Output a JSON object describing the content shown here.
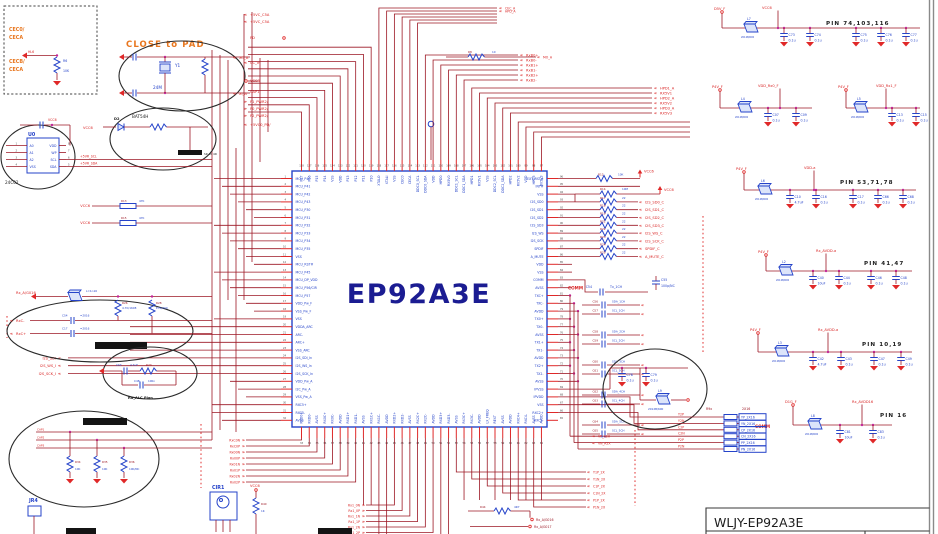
{
  "colors": {
    "wire": "#9c1724",
    "bright": "#e02828",
    "component_blue": "#2543c9",
    "chip_navy": "#1b1c92",
    "orange": "#e8761e",
    "junction_pink": "#c2269a"
  },
  "title_block": {
    "title": "WLJY-EP92A3E"
  },
  "notes": {
    "close_to_pad": "CLOSE to PAD"
  },
  "chip": {
    "label": "EP92A3E",
    "left_pins": [
      "MCU_P40",
      "MCU_P41",
      "MCU_P42",
      "MCU_P43",
      "MCU_P30",
      "MCU_P31",
      "MCU_P32",
      "MCU_P33",
      "MCU_P34",
      "MCU_P35",
      "VSS",
      "MCU_RST#",
      "MCU_P45",
      "MCU_DP_VDD",
      "MCU_P56/CIR",
      "MCU_P57",
      "VDD_Pw_F",
      "VSS_Pw_F",
      "VSS",
      "VDDA_ARC",
      "ARC-",
      "ARC+",
      "VSS_ARC",
      "I2S_SDI_In",
      "I2S_WS_In",
      "I2S_SCK_In",
      "VDD_Pw_A",
      "I2C_Pw_A",
      "VSS_Pw_A",
      "RXC5+",
      "RXC5-",
      "AVSS"
    ],
    "right_pins": [
      "EXT_RST#",
      "INT#",
      "VSS",
      "I2S_SD0",
      "I2S_SD1",
      "I2S_SD2",
      "I2S_SD3",
      "I2S_WS",
      "I2S_SCK",
      "SPDIF",
      "A_MUTE",
      "VDD",
      "VSS",
      "COMM",
      "AVSS",
      "TXC+",
      "TXC-",
      "AVDD",
      "TX0+",
      "TX0-",
      "AVSS",
      "TX1+",
      "TX1-",
      "AVDD",
      "TX2+",
      "TX2-",
      "AVSS",
      "IPVSS",
      "IPVDD",
      "VSS",
      "RXC2+",
      "RXC2-"
    ],
    "top_pins": [
      "P17",
      "P16",
      "P15",
      "P14",
      "VSS",
      "VDD",
      "P13",
      "P12",
      "P11",
      "P10",
      "XTALO",
      "XTALI",
      "VSS",
      "CEC0",
      "CECA",
      "DDC0_SCL",
      "DDC0_SDA",
      "VDD",
      "HPD0",
      "RX5V0",
      "DDC1_SCL",
      "DDC1_SDA",
      "HPD1",
      "RX5V1",
      "VSS",
      "DDC2_SCL",
      "DDC2_SDA",
      "HPD2",
      "RX5V2",
      "VDD",
      "HPD3",
      "RX5V3"
    ],
    "bottom_pins": [
      "RXD0+",
      "RXD0-",
      "AVSS",
      "RX0C+",
      "RX0C-",
      "AVDD",
      "RXD1+",
      "RXD1-",
      "AVSS",
      "RX1C+",
      "RX1C-",
      "AVDD",
      "RXD2+",
      "RXD2-",
      "AVSS",
      "RX2C+",
      "RX2C-",
      "AVDD",
      "RXD3+",
      "RXD3-",
      "AVSS",
      "RX3C+",
      "RX3C-",
      "AVDD",
      "LX_FREQ",
      "REXT",
      "AVSS",
      "AVDD",
      "RXC4+",
      "RXC4-",
      "AVSS",
      "AVDD"
    ]
  },
  "cec_box": {
    "top1": "CEC0/",
    "top2": "CECA",
    "net": "HL6",
    "bot1": "CECB/",
    "bot2": "CECA",
    "r_ref": "R6",
    "r_val": "10K"
  },
  "crystal": {
    "ref": "Y1",
    "val": "24M",
    "net_top": "XO_A",
    "net_bot": "XI_A"
  },
  "diode": {
    "net": "VCC6",
    "ref": "D2",
    "part": "BAT54H",
    "ind": "SR 40 4R"
  },
  "eeprom": {
    "ref": "U0",
    "part": "24C02",
    "cap_net": "VCC6",
    "left_pins": [
      "A0",
      "A1",
      "A2",
      "VSS"
    ],
    "right_pins": [
      "VDD",
      "WP",
      "SCL",
      "SDA"
    ],
    "nets": [
      "+5VR_SCL",
      "+5VR_SDA"
    ]
  },
  "power_groups": [
    {
      "title": "PIN 74,103,116",
      "left": "D5V_F",
      "right": "VCC6",
      "bead_ref": "L7",
      "bead": "2012B/600",
      "caps": [
        {
          "r": "C73",
          "v": "0.1u"
        },
        {
          "r": "C74",
          "v": "0.1u"
        },
        {
          "r": "C75",
          "v": "0.1u"
        },
        {
          "r": "C76",
          "v": "0.1u"
        },
        {
          "r": "C77",
          "v": "0.1u"
        }
      ]
    },
    {
      "title": "",
      "left": "P4V_F",
      "right": "VDD_Rx0_F",
      "bead_ref": "L4",
      "bead": "2012B/600",
      "caps": [
        {
          "r": "C07",
          "v": "0.1u"
        },
        {
          "r": "C09",
          "v": "0.1u"
        }
      ]
    },
    {
      "title": "",
      "left": "P4V_F",
      "right": "VDD_Rx1_F",
      "bead_ref": "L5",
      "bead": "2012B/600",
      "caps": [
        {
          "r": "C13",
          "v": "0.1u"
        },
        {
          "r": "C15",
          "v": "0.1u"
        }
      ]
    },
    {
      "title": "PIN 53,71,78",
      "left": "P4V_F",
      "right": "VDD-a",
      "bead_ref": "L6",
      "bead": "2012B/600",
      "caps": [
        {
          "r": "C10",
          "v": "4.7uF"
        },
        {
          "r": "C16",
          "v": "0.1u"
        },
        {
          "r": "C17",
          "v": "0.1u"
        },
        {
          "r": "C66",
          "v": "0.1u"
        },
        {
          "r": "C68",
          "v": "0.1u"
        }
      ]
    },
    {
      "title": "PIN 41,47",
      "left": "P4V_F",
      "right": "Rx_AVDD-a",
      "bead_ref": "L2",
      "bead": "2012B/600",
      "caps": [
        {
          "r": "C40",
          "v": "10uF"
        },
        {
          "r": "C44",
          "v": "0.1u"
        },
        {
          "r": "C46",
          "v": "0.1u"
        },
        {
          "r": "C48",
          "v": "0.1u"
        }
      ]
    },
    {
      "title": "PIN 10,19",
      "left": "P4V_F",
      "right": "Rx_AVDD-a",
      "bead_ref": "L3",
      "bead": "2012B/600",
      "caps": [
        {
          "r": "C42",
          "v": "4.7uF"
        },
        {
          "r": "C43",
          "v": "0.1u"
        },
        {
          "r": "C47",
          "v": "0.1u"
        },
        {
          "r": "C49",
          "v": "0.1u"
        }
      ]
    },
    {
      "title": "PIN 16",
      "left": "D1G_F",
      "right": "Rx_AVDD16",
      "bead_ref": "L8",
      "bead": "2012B/600",
      "comm": "COMM",
      "caps": [
        {
          "r": "C81",
          "v": "10uF"
        },
        {
          "r": "C83",
          "v": "0.1u"
        }
      ]
    }
  ],
  "e7": {
    "bead_ref": "L9",
    "bead": "2012B/600",
    "caps": [
      {
        "r": "C78",
        "v": "0.1u"
      },
      {
        "r": "C79",
        "v": "0.1u"
      }
    ]
  },
  "resnet": {
    "hdr_l": "R9x",
    "hdr_r": "2X16",
    "rows": [
      {
        "l": "Y2P",
        "b": "YP_2X16"
      },
      {
        "l": "Y2N",
        "b": "YN_2X16"
      },
      {
        "l": "C2P",
        "b": "CP_2X16"
      },
      {
        "l": "C2N",
        "b": "CN_2X16"
      },
      {
        "l": "P2P",
        "b": "PP_2X16"
      },
      {
        "l": "P2N",
        "b": "PN_2X16"
      }
    ]
  },
  "left_col": [
    "+5VC_C5A",
    "+5VC_C5A",
    "PD",
    "CC_In",
    "VCC6",
    "CAP1",
    "P1_PWR2/",
    "P0_PWR2/",
    "P2_PWR2/",
    "+5VC0_PD/"
  ],
  "vcc_rows": [
    {
      "net": "VCC6",
      "ref": "R13",
      "val": "47K"
    },
    {
      "net": "VCC6",
      "ref": "R15",
      "val": "47K"
    }
  ],
  "topright": {
    "r_ref": "R8",
    "r_val": "10",
    "net": "MO_A",
    "top2": [
      "CEC_A",
      "HPD_A"
    ],
    "stack": [
      "RxB0+",
      "RxB0-",
      "RxB1+",
      "RxB1-",
      "RxB2+",
      "RxB2-"
    ],
    "mid": [
      "HPD1_A",
      "RX5V1",
      "HPD2_A",
      "RX5V2",
      "HPD3_A",
      "RX5V3"
    ]
  },
  "pullup": {
    "ref": "R12",
    "val": "10K",
    "net": "VCC6"
  },
  "i2s": {
    "val": "22",
    "refs": [
      "R17",
      "R18",
      "R19",
      "R21",
      "R22",
      "R23",
      "R24",
      "R25"
    ],
    "labels": [
      "I2S_SD0_C",
      "I2S_SD1_C",
      "I2S_SD2_C",
      "I2S_SD3_C",
      "I2S_WS_C",
      "I2S_SCK_C",
      "SPDIF_C",
      "A_MUTE_C"
    ],
    "pull": {
      "ref": "R1b",
      "val": "10M",
      "net": "VCC6"
    }
  },
  "commcaps": {
    "hdr": "COMM",
    "hdr_ref": "C54",
    "hdr_lab": "Tx_1CH",
    "nc_ref": "C55",
    "nc_val": "100p/NC",
    "rows": [
      {
        "ref": "C56",
        "lab": "SDA_1CH"
      },
      {
        "ref": "C57",
        "lab": "SCL_1CH"
      },
      {
        "ref": "C58",
        "lab": "SDA_2CH"
      },
      {
        "ref": "C59",
        "lab": "SCL_2CH"
      },
      {
        "ref": "C60",
        "lab": "SDA_3CH"
      },
      {
        "ref": "C61",
        "lab": "SCL_3CH"
      },
      {
        "ref": "C62",
        "lab": "SDA_4CH"
      },
      {
        "ref": "C63",
        "lab": "SCL_4CH"
      },
      {
        "ref": "C64",
        "lab": "SDA_5CH"
      },
      {
        "ref": "C65",
        "lab": "SCL_5CH"
      }
    ]
  },
  "filters": {
    "net": "Rx_A/G016",
    "bead": "L=1n16",
    "r1_ref": "R26",
    "r1_val": "4.7K/1608",
    "r2_ref": "R28",
    "r2_val": "E78/400",
    "c1": "C54",
    "c2": "C17",
    "cv": "=2016",
    "in1": "RxC-",
    "in2": "RxC+"
  },
  "agc": {
    "c1_ref": "C63",
    "c1_val": "4.7uF",
    "r_ref": "R20",
    "c2_ref": "C48",
    "c2_val": "100n",
    "note": "Ra_ALC Plan"
  },
  "bottom_ellipse": {
    "nets": [
      "CAP1",
      "CAP2",
      "CAP3"
    ],
    "res": [
      {
        "ref": "R34",
        "val": "10K"
      },
      {
        "ref": "R35",
        "val": "10K"
      },
      {
        "ref": "R36",
        "val": "10K/NC"
      }
    ]
  },
  "jr4": "JR4",
  "cir1": {
    "label": "CIR1",
    "net": "VCC6",
    "r_ref": "R40",
    "r_val": "1K"
  },
  "colA": [
    "RxC0N",
    "RxC0P",
    "Rx00N",
    "Rx00P",
    "Rx01N",
    "Rx01P",
    "Rx02N",
    "Rx02P"
  ],
  "colB": [
    "Rx1_0N",
    "Rx1_0P",
    "Rx1_1N",
    "Rx1_1P",
    "Rx1_2N",
    "Rx1_2P"
  ],
  "colC": [
    "VP_A2X",
    "VN_A2X"
  ],
  "colD": [
    "Y1P_2X",
    "Y1N_2X",
    "C1P_2X",
    "C1N_2X",
    "P1P_2X",
    "P1N_2X"
  ],
  "bot_nets": {
    "r_ref": "R44",
    "r_val": "4R7",
    "rows": [
      "Rx_A/G016",
      "Rx_A/G017"
    ]
  },
  "left_in": [
    "I2S_SDI",
    "I2S_WS_I",
    "I2S_SCK_I"
  ]
}
